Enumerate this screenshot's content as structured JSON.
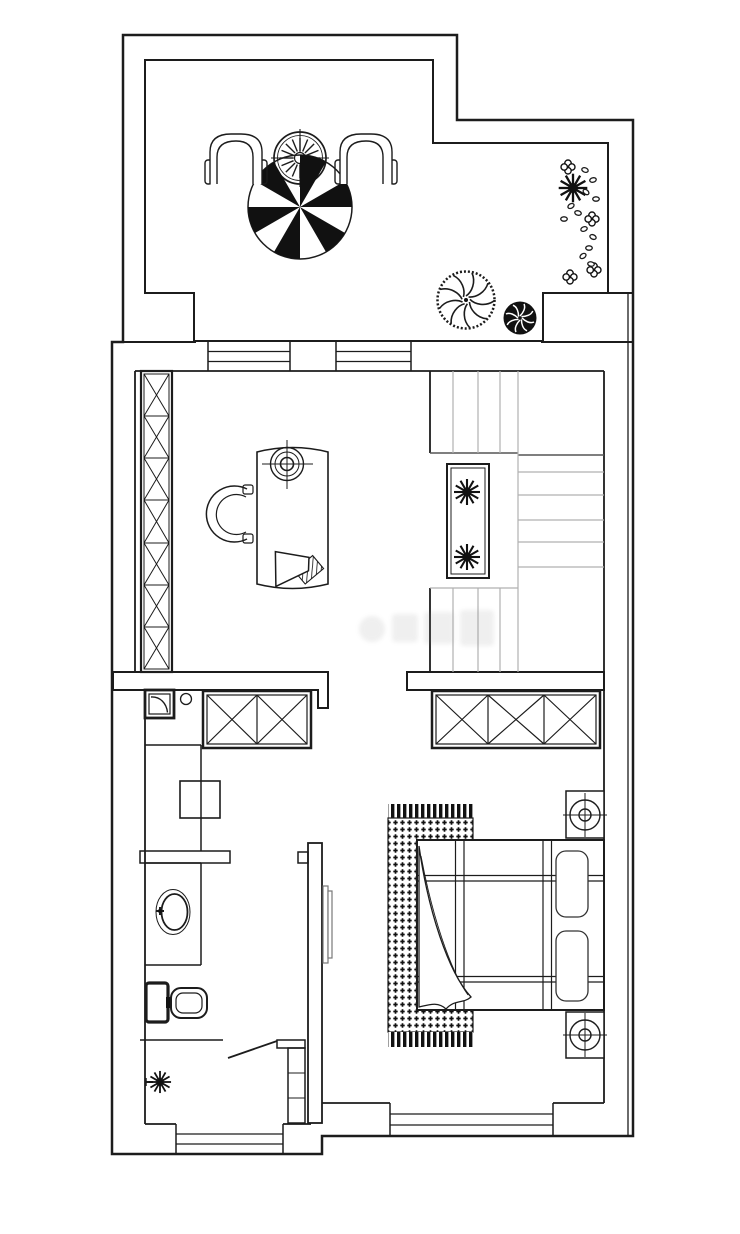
{
  "image": {
    "type": "residential floor plan",
    "style": "monochrome CAD line drawing, top-down view, no text labels",
    "width_px": 740,
    "height_px": 1234
  },
  "colors": {
    "background": "#ffffff",
    "line": "#1c1c1c",
    "black_fill": "#111111",
    "stair_tread_gray": "#b0b0b0",
    "tv_gray": "#777777",
    "watermark_gray": "#888888"
  },
  "areas": [
    {
      "id": "terrace",
      "position": "top",
      "features": [
        "round-table-with-radial-hatch",
        "patio-umbrella-pinwheel",
        "tub-chair-left",
        "tub-chair-right",
        "large-swirl-bush",
        "small-swirl-bush",
        "flower-bed-with-clovers-ovals-starburst"
      ]
    },
    {
      "id": "study",
      "position": "middle-left",
      "features": [
        "tall-wardrobe-7-x-sections",
        "arched-desk",
        "desk-lamp-symbol",
        "horseshoe-chair",
        "hatched-speaker-object",
        "window-to-terrace-1",
        "window-to-terrace-2"
      ]
    },
    {
      "id": "stairwell",
      "position": "middle-right",
      "features": [
        "upper-flight-vertical-treads",
        "side-flight-horizontal-treads",
        "lower-flight-vertical-treads",
        "double-border-planter-with-2-starburst-plants"
      ]
    },
    {
      "id": "bathroom",
      "position": "bottom-left",
      "features": [
        "corner-basin-with-curve",
        "cabinet-2-x-sections",
        "faucet-circle",
        "washing-machine-square",
        "counter-with-oval-sink",
        "toilet-thick-tank",
        "partial-divider-wall",
        "swing-door-leaf",
        "shelf-column-3-cells",
        "potted-plant-starburst",
        "bottom-window"
      ]
    },
    {
      "id": "bedroom",
      "position": "bottom-right",
      "features": [
        "wardrobe-3-x-sections",
        "nightstand-lamp-top",
        "nightstand-lamp-bottom",
        "double-bed-with-grid-lines",
        "two-sketchy-pillows",
        "folded-blanket-corner",
        "fringed-dotted-rug",
        "wall-mounted-tv-side-view",
        "bottom-window"
      ]
    }
  ],
  "watermark": {
    "present": true,
    "legible": false,
    "location": "center of stair hall"
  }
}
